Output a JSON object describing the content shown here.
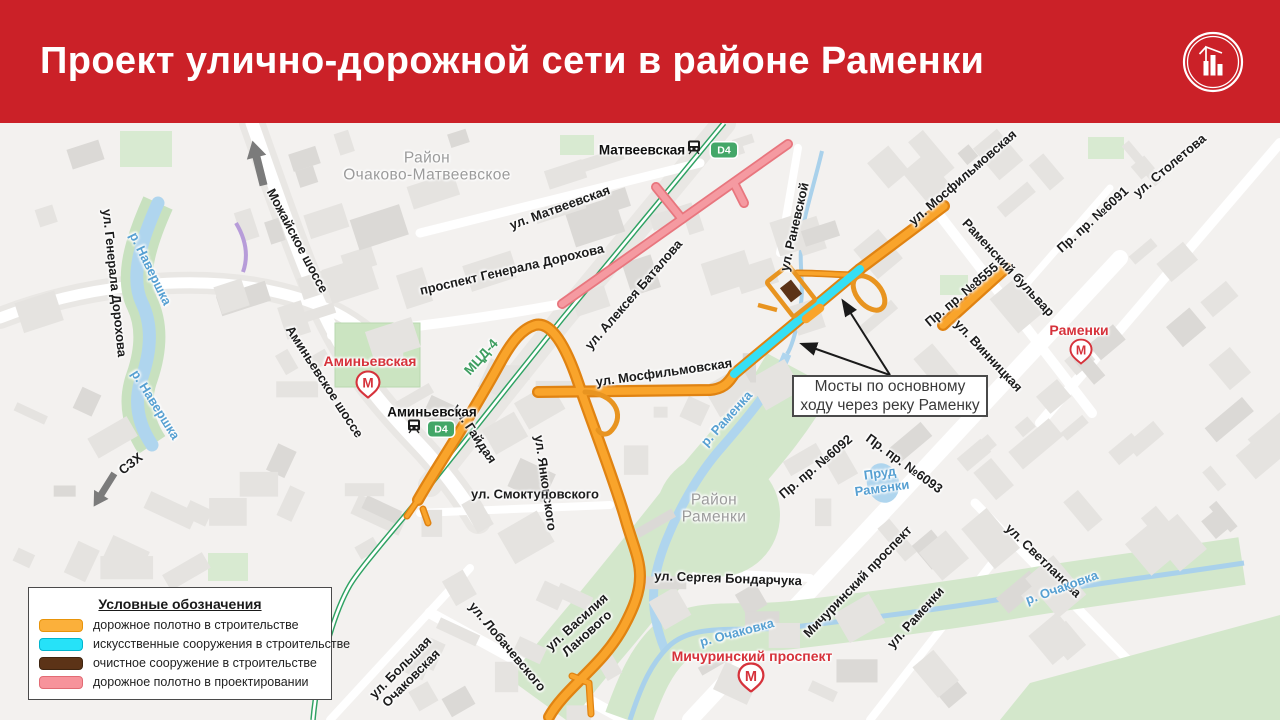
{
  "header": {
    "title": "Проект улично-дорожной сети в районе Раменки"
  },
  "colors": {
    "header_red": "#CB2128",
    "metro_red": "#D6323B",
    "road_construction": "#F9A42B",
    "road_construction_casing": "#E08312",
    "bridge_cyan": "#35DFF5",
    "treatment_brown": "#5C3317",
    "road_design_pink": "#F59AA1",
    "rail_green": "#2FA263",
    "water_blue": "#AFD5EE",
    "park_green": "#CBE4C1",
    "label_water": "#57A0D2",
    "label_district": "#9B9B9B"
  },
  "legend": {
    "title": "Условные обозначения",
    "items": [
      {
        "color": "#FBB03B",
        "border": "#E8940A",
        "label": "дорожное полотно в строительстве"
      },
      {
        "color": "#26E2F8",
        "border": "#00B5CE",
        "label": "искусственные сооружения в строительстве"
      },
      {
        "color": "#5C3317",
        "border": "#3E2410",
        "label": "очистное сооружение в строительстве"
      },
      {
        "color": "#F7939B",
        "border": "#E26B74",
        "label": "дорожное полотно в проектировании"
      }
    ]
  },
  "callout": {
    "line1": "Мосты по основному",
    "line2": "ходу через реку Раменку"
  },
  "badge_label": "D4",
  "labels": [
    {
      "t": "Район\nОчаково-Матвеевское",
      "x": 427,
      "y": 44,
      "r": 0,
      "c": "d"
    },
    {
      "t": "Район\nРаменки",
      "x": 714,
      "y": 386,
      "r": 0,
      "c": "d"
    },
    {
      "t": "Можайское шоссе",
      "x": 297,
      "y": 118,
      "r": 62,
      "c": "st"
    },
    {
      "t": "ул. Генерала Дорохова",
      "x": 114,
      "y": 160,
      "r": 84,
      "c": "st"
    },
    {
      "t": "ул. Матвеевская",
      "x": 560,
      "y": 85,
      "r": -20,
      "c": "st"
    },
    {
      "t": "проспект Генерала Дорохова",
      "x": 512,
      "y": 147,
      "r": -13,
      "c": "st"
    },
    {
      "t": "ул. Алексея Баталова",
      "x": 634,
      "y": 172,
      "r": -49,
      "c": "st"
    },
    {
      "t": "ул. Раневской",
      "x": 795,
      "y": 104,
      "r": -77,
      "c": "st"
    },
    {
      "t": "ул. Мосфильмовская",
      "x": 963,
      "y": 55,
      "r": -41,
      "c": "st"
    },
    {
      "t": "ул. Столетова",
      "x": 1170,
      "y": 43,
      "r": -40,
      "c": "st"
    },
    {
      "t": "Пр. пр. №6091",
      "x": 1093,
      "y": 97,
      "r": -42,
      "c": "st"
    },
    {
      "t": "Раменский бульвар",
      "x": 1008,
      "y": 145,
      "r": 47,
      "c": "st"
    },
    {
      "t": "Пр. пр. №8555",
      "x": 962,
      "y": 172,
      "r": -40,
      "c": "st"
    },
    {
      "t": "ул. Винницкая",
      "x": 988,
      "y": 233,
      "r": 47,
      "c": "st"
    },
    {
      "t": "ул. Мосфильмовская",
      "x": 664,
      "y": 250,
      "r": -8,
      "c": "st"
    },
    {
      "t": "Аминьевское шоссе",
      "x": 324,
      "y": 259,
      "r": 57,
      "c": "st"
    },
    {
      "t": "МЦД-4",
      "x": 481,
      "y": 234,
      "r": -48,
      "c": "rl"
    },
    {
      "t": "ул. Гайдая",
      "x": 474,
      "y": 311,
      "r": 56,
      "c": "st"
    },
    {
      "t": "ул. Янковского",
      "x": 545,
      "y": 360,
      "r": 82,
      "c": "st"
    },
    {
      "t": "ул. Смоктуновского",
      "x": 535,
      "y": 372,
      "r": 0,
      "c": "st"
    },
    {
      "t": "ул. Сергея Бондарчука",
      "x": 728,
      "y": 456,
      "r": 2,
      "c": "st"
    },
    {
      "t": "ул. Василия\nЛанового",
      "x": 582,
      "y": 505,
      "r": -42,
      "c": "st"
    },
    {
      "t": "ул. Лобачевского",
      "x": 507,
      "y": 524,
      "r": 50,
      "c": "st"
    },
    {
      "t": "ул. Большая\nОчаковская",
      "x": 406,
      "y": 550,
      "r": -45,
      "c": "st"
    },
    {
      "t": "Мичуринский проспект",
      "x": 858,
      "y": 459,
      "r": -46,
      "c": "st"
    },
    {
      "t": "ул. Раменки",
      "x": 916,
      "y": 495,
      "r": -48,
      "c": "st"
    },
    {
      "t": "ул. Светланова",
      "x": 1043,
      "y": 438,
      "r": 44,
      "c": "st"
    },
    {
      "t": "Пр. пр. №6092",
      "x": 816,
      "y": 344,
      "r": -40,
      "c": "st"
    },
    {
      "t": "Пр. пр. №6093",
      "x": 904,
      "y": 341,
      "r": 36,
      "c": "st"
    },
    {
      "t": "СЗХ",
      "x": 131,
      "y": 341,
      "r": -38,
      "c": "st"
    },
    {
      "t": "р. Навершка",
      "x": 150,
      "y": 146,
      "r": 64,
      "c": "w"
    },
    {
      "t": "р. Навершка",
      "x": 155,
      "y": 282,
      "r": 58,
      "c": "w"
    },
    {
      "t": "р. Раменка",
      "x": 727,
      "y": 296,
      "r": -48,
      "c": "w"
    },
    {
      "t": "р. Очаковка",
      "x": 737,
      "y": 510,
      "r": -15,
      "c": "w"
    },
    {
      "t": "р. Очаковка",
      "x": 1062,
      "y": 465,
      "r": -20,
      "c": "w"
    },
    {
      "t": "Пруд\nРаменки",
      "x": 881,
      "y": 358,
      "r": -8,
      "c": "w"
    },
    {
      "t": "Аминьевская",
      "x": 370,
      "y": 239,
      "r": 0,
      "c": "red"
    },
    {
      "t": "Раменки",
      "x": 1079,
      "y": 208,
      "r": 0,
      "c": "red"
    },
    {
      "t": "Мичуринский проспект",
      "x": 752,
      "y": 534,
      "r": 0,
      "c": "red"
    },
    {
      "t": "Матвеевская",
      "x": 642,
      "y": 27,
      "r": 0,
      "c": "blk"
    },
    {
      "t": "Аминьевская",
      "x": 432,
      "y": 289,
      "r": 0,
      "c": "blk"
    }
  ],
  "icons": [
    {
      "type": "metro",
      "name": "metro-icon-aminyevskaya",
      "x": 368,
      "y": 264,
      "s": 25
    },
    {
      "type": "metro",
      "name": "metro-icon-ramenki",
      "x": 1081,
      "y": 231,
      "s": 23
    },
    {
      "type": "metro",
      "name": "metro-icon-michurinsky-prospekt",
      "x": 751,
      "y": 557,
      "s": 27
    },
    {
      "type": "train",
      "name": "rail-station-icon-matveevskaya",
      "x": 694,
      "y": 27
    },
    {
      "type": "train",
      "name": "rail-station-icon-aminyevskaya",
      "x": 414,
      "y": 306
    },
    {
      "type": "d4",
      "name": "d4-line-badge-matveevskaya",
      "x": 724,
      "y": 27
    },
    {
      "type": "d4",
      "name": "d4-line-badge-aminyevskaya",
      "x": 441,
      "y": 306
    }
  ]
}
